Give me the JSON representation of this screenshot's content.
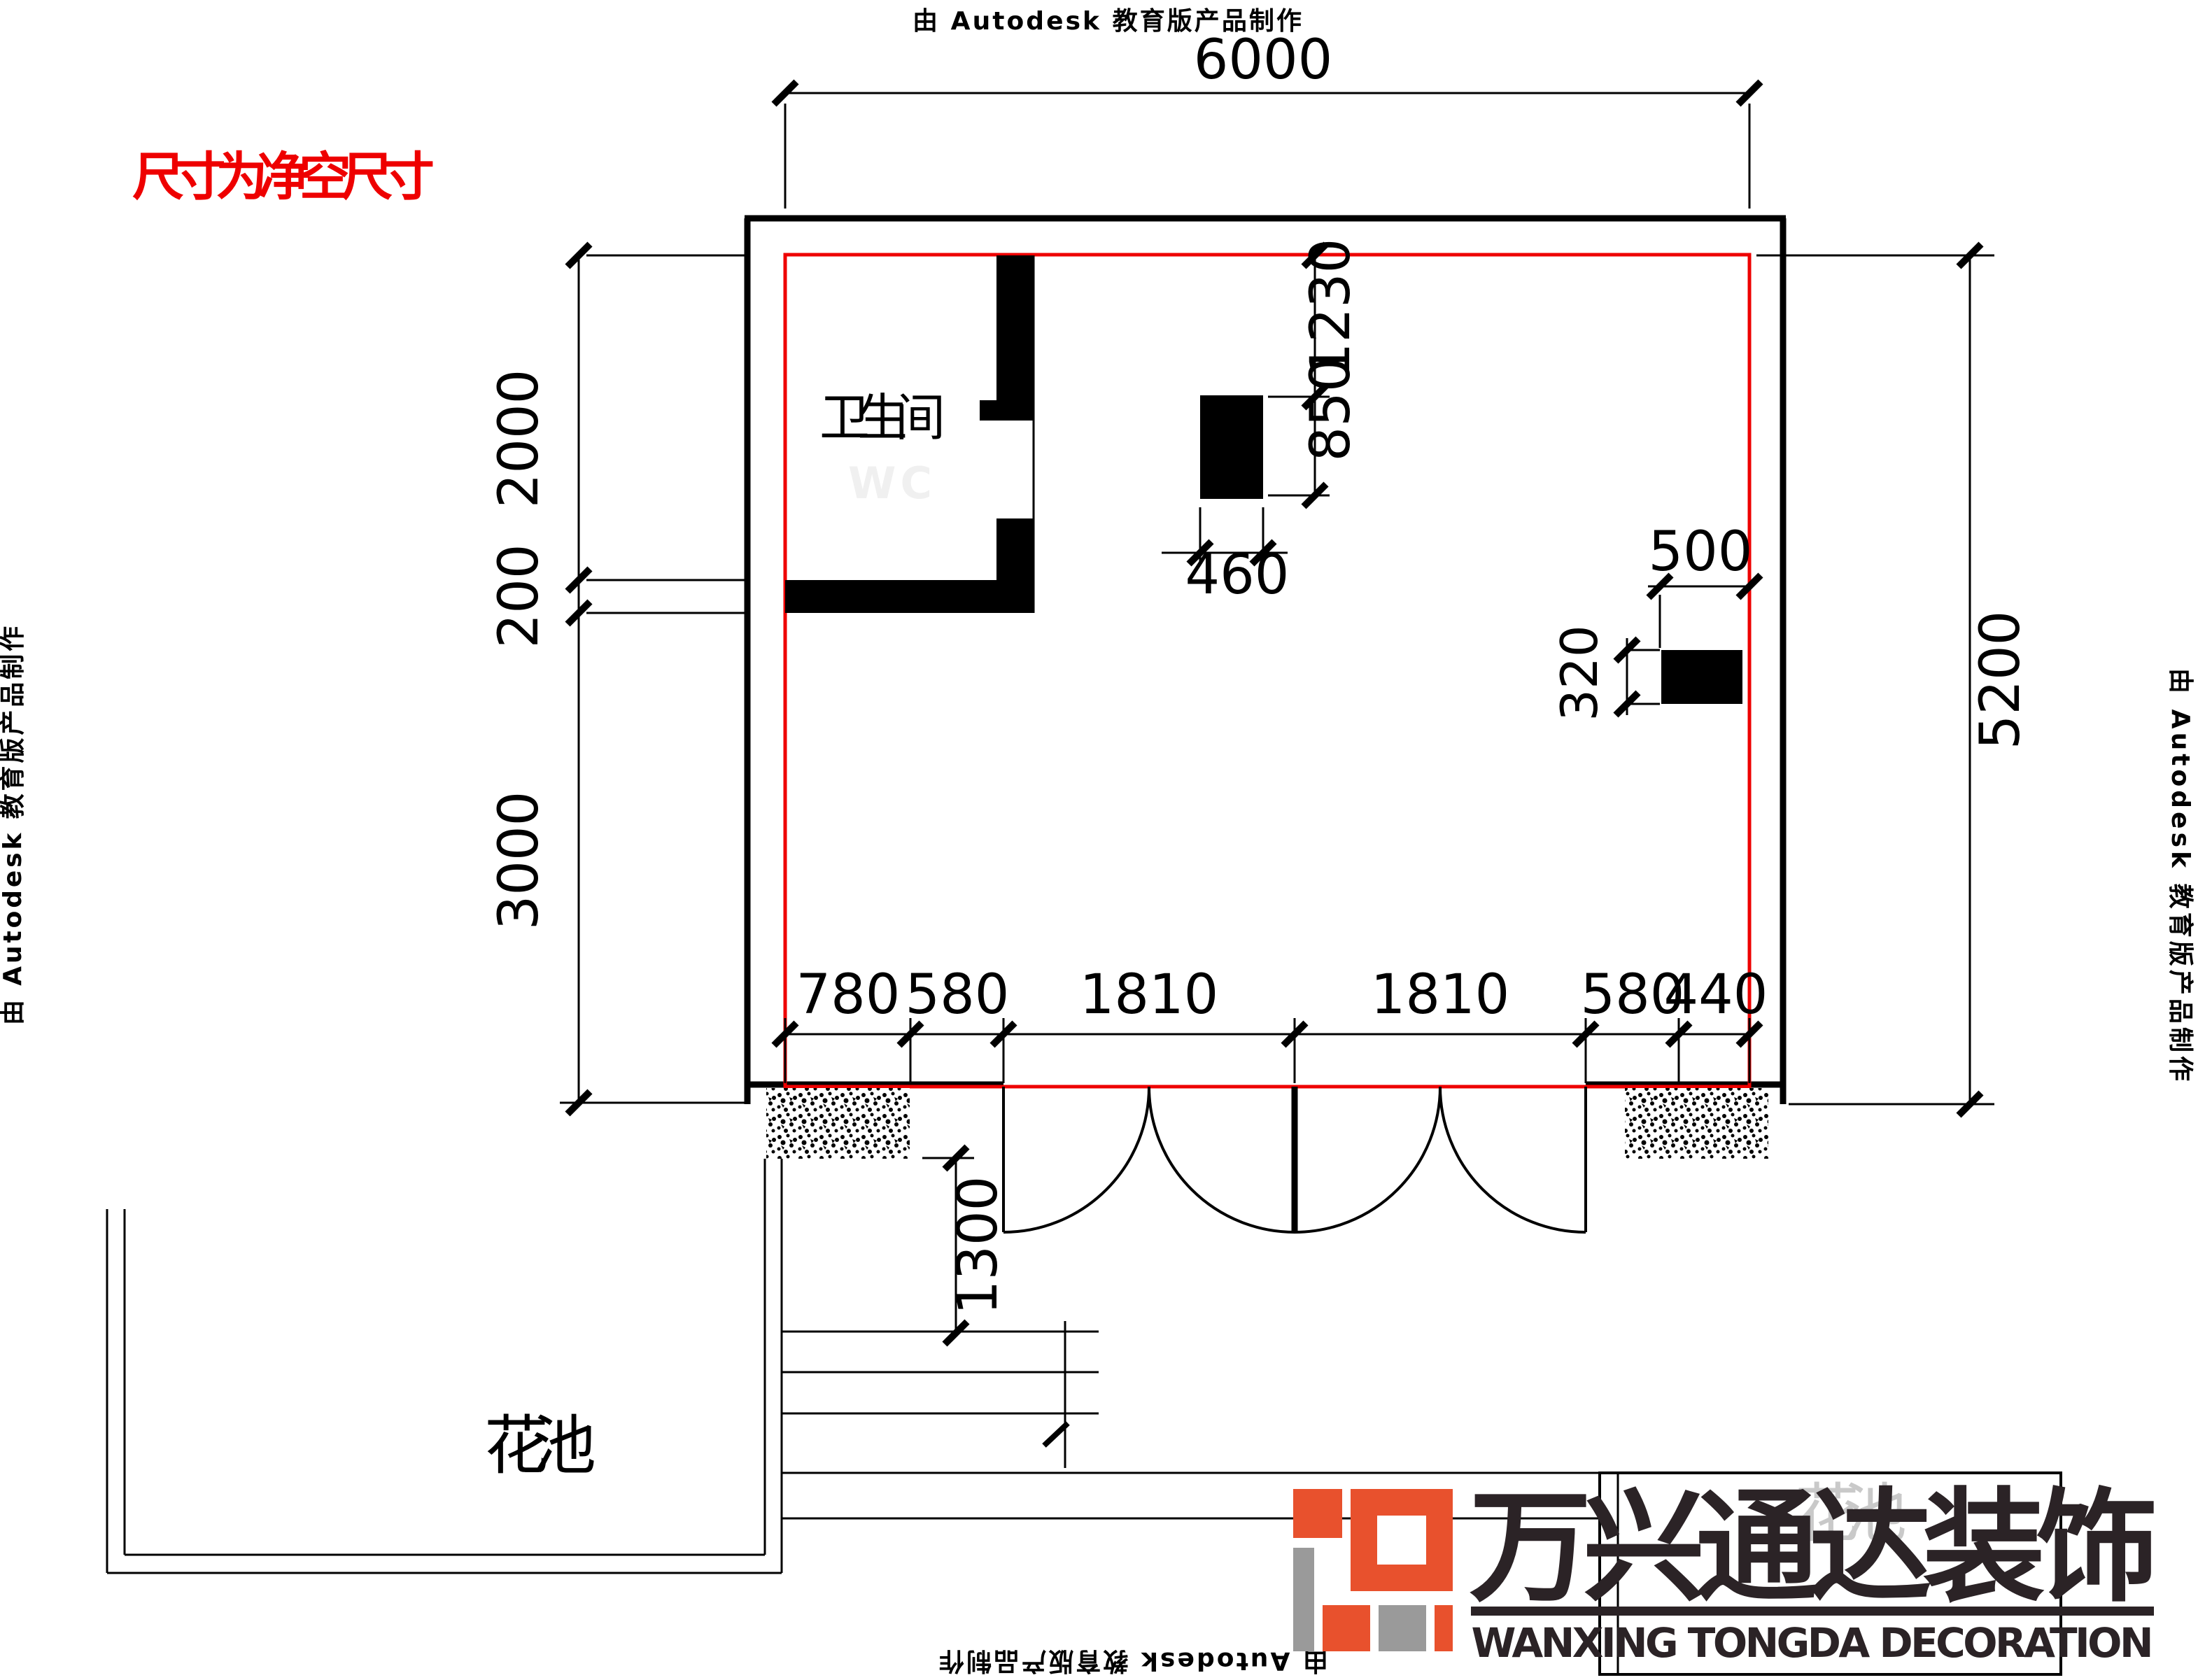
{
  "page": {
    "background": "#ffffff"
  },
  "colors": {
    "red": "#ee0000",
    "black": "#000000",
    "wc_ghost": "#f0f0f0",
    "ghost_gray": "#c9c9c9",
    "logo_orange": "#e8512d",
    "logo_gray": "#9a9a9a",
    "logo_dark": "#2b2326"
  },
  "watermarks": {
    "top": "由 Autodesk 教育版产品制作",
    "left": "由 Autodesk 教育版产品制作",
    "right": "由 Autodesk 教育版产品制作",
    "bottom": "由 Autodesk 教育版产品制作"
  },
  "annotations": {
    "clearance_note": "尺寸为净空尺寸",
    "bathroom": "卫生间",
    "bathroom_en": "WC",
    "flower_bed": "花池",
    "flower_bed_2": "花池"
  },
  "dimensions": {
    "top_width": "6000",
    "right_height": "5200",
    "left_top": "2000",
    "left_wall": "200",
    "left_bottom": "3000",
    "fixture_top": "1230",
    "fixture_side": "850",
    "fixture_width": "460",
    "block_width": "500",
    "block_height": "320",
    "entrance_depth": "1300",
    "bottom_segments": [
      "780",
      "580",
      "1810",
      "1810",
      "580",
      "440"
    ]
  },
  "logo": {
    "name_cn": "万兴通达装饰",
    "name_en": "WANXING TONGDA DECORATION"
  }
}
